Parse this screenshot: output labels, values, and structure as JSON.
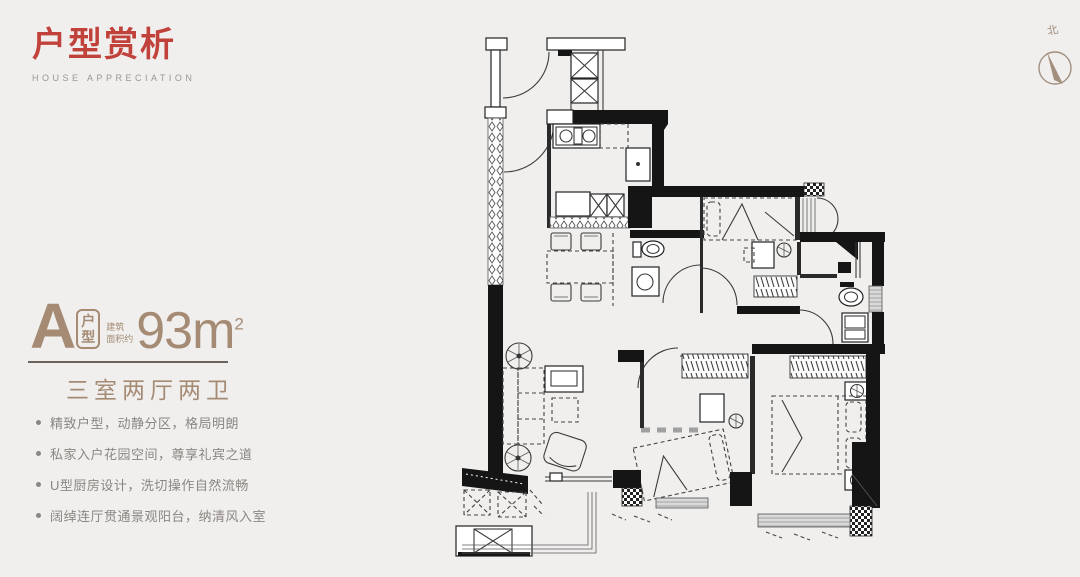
{
  "page": {
    "background": "#f0efee"
  },
  "header": {
    "title": "户型赏析",
    "subtitle": "HOUSE APPRECIATION"
  },
  "unit": {
    "letter": "A",
    "type_top": "户",
    "type_bottom": "型",
    "area_note_line1": "建筑",
    "area_note_line2": "面积约",
    "area_value": "93m",
    "area_sup": "2",
    "layout": "三室两厅两卫"
  },
  "features": {
    "items": [
      "精致户型，动静分区，格局明朗",
      "私家入户花园空间，尊享礼宾之道",
      "U型厨房设计，洗切操作自然流畅",
      "阔绰连厅贯通景观阳台，纳清风入室"
    ]
  },
  "compass": {
    "label": "北"
  },
  "colors": {
    "accent_red": "#c0423a",
    "taupe": "#a58b74",
    "feature_text": "#8b8681",
    "plan_ink": "#1a1a1a"
  }
}
